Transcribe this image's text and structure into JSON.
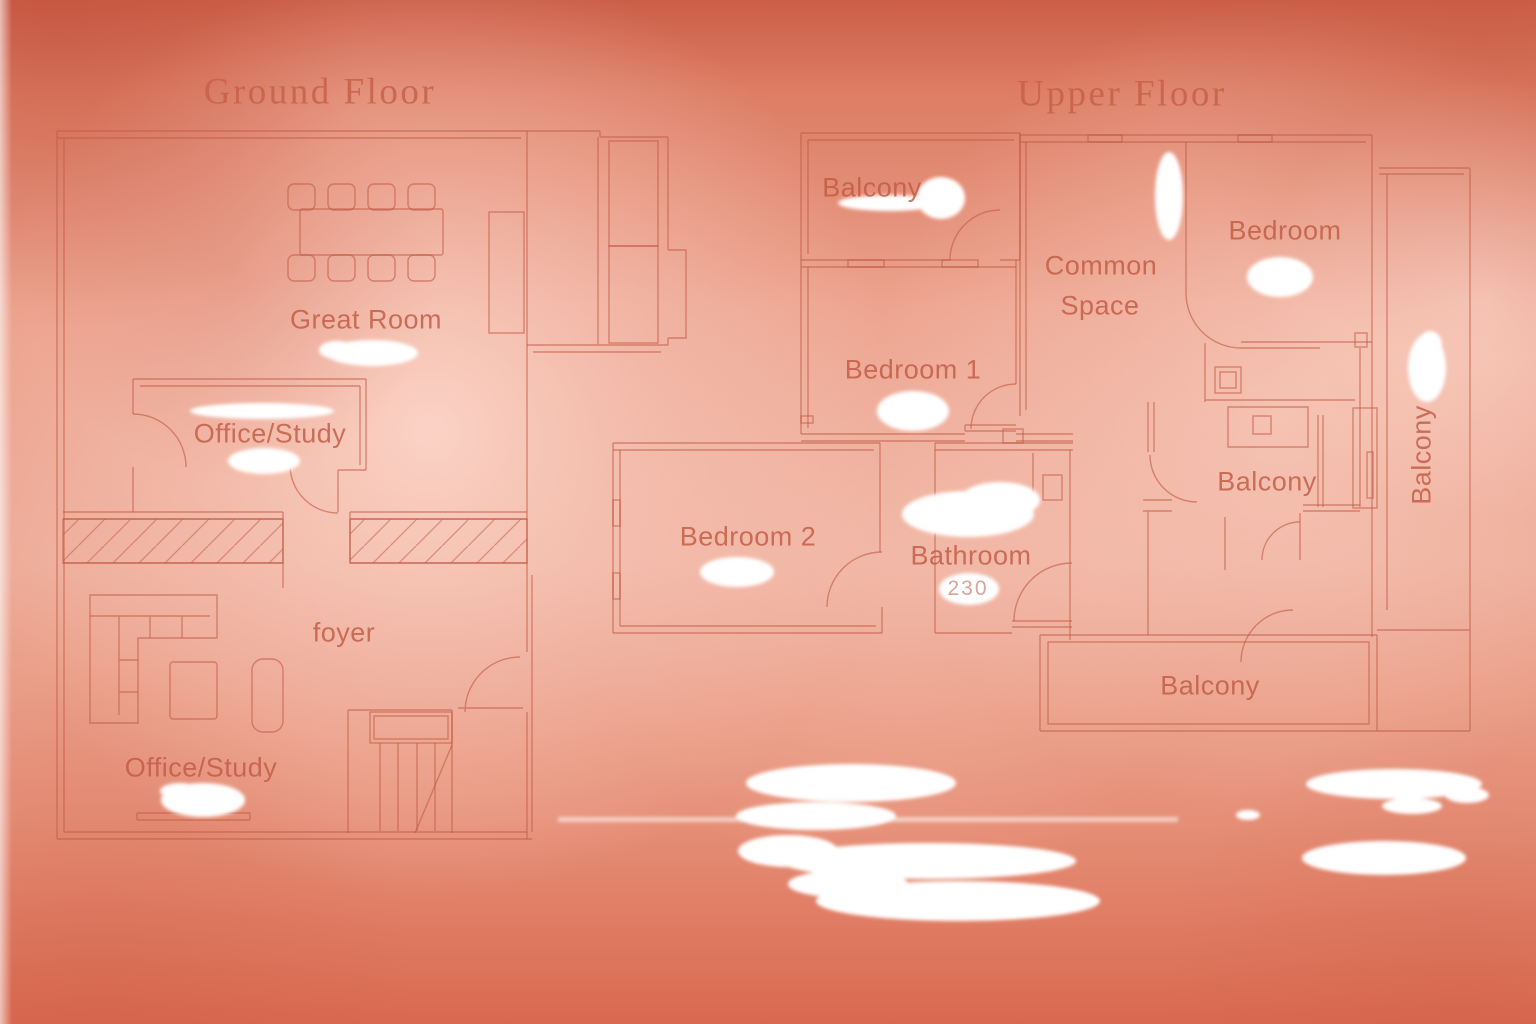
{
  "canvas": {
    "width": 1536,
    "height": 1024
  },
  "colors": {
    "background_edge": "#cd5f49",
    "background_mid": "#e89a84",
    "background_light": "#f5c2b1",
    "wall_line": "#c25c46",
    "label_text": "#c15a43",
    "title_text": "#c76048",
    "erasure": "#ffffff"
  },
  "ground_floor": {
    "title": "Ground Floor",
    "labels": [
      {
        "id": "great-room",
        "text": "Great Room"
      },
      {
        "id": "office-study-upper",
        "text": "Office/Study"
      },
      {
        "id": "foyer",
        "text": "foyer"
      },
      {
        "id": "office-study-lower",
        "text": "Office/Study"
      }
    ]
  },
  "upper_floor": {
    "title": "Upper Floor",
    "labels": [
      {
        "id": "balcony-top-left",
        "text": "Balcony"
      },
      {
        "id": "common-space-line1",
        "text": "Common"
      },
      {
        "id": "common-space-line2",
        "text": "Space"
      },
      {
        "id": "bedroom",
        "text": "Bedroom"
      },
      {
        "id": "bedroom-1",
        "text": "Bedroom 1"
      },
      {
        "id": "bedroom-2",
        "text": "Bedroom 2"
      },
      {
        "id": "bathroom",
        "text": "Bathroom"
      },
      {
        "id": "balcony-middle",
        "text": "Balcony"
      },
      {
        "id": "balcony-bottom",
        "text": "Balcony"
      },
      {
        "id": "balcony-right-vertical",
        "text": "Balcony"
      }
    ],
    "dimension_remnant": "230"
  }
}
